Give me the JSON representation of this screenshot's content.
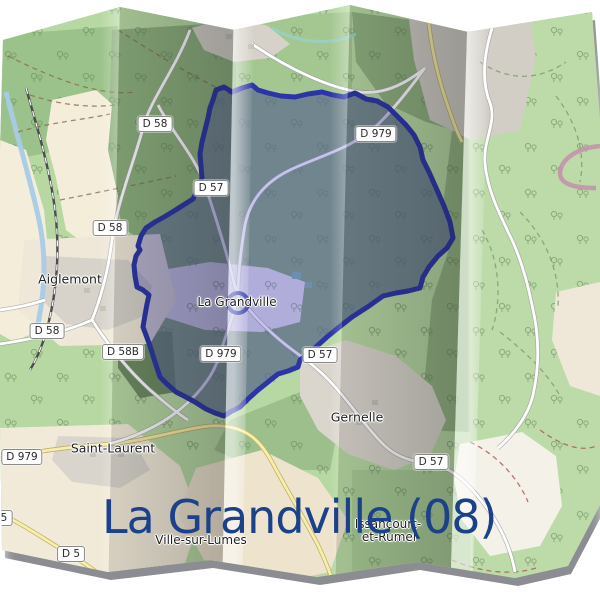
{
  "title": {
    "text": "La Grandville (08)",
    "color": "#1a4189"
  },
  "colors": {
    "boundary": "#2b35a8",
    "boundary_fill": "rgba(70,72,190,0.32)",
    "forest_green": "#8caf7c",
    "base_green": "#b7d8a2",
    "clearing_beige": "#f2ead8",
    "road_yellow": "#f6efab",
    "river_blue": "#a8cbe8"
  },
  "places": {
    "aiglemont": "Aiglemont",
    "la_grandville": "La Grandville",
    "gernelle": "Gernelle",
    "saint_laurent": "Saint-Laurent",
    "ville_sur_lumes": "Ville-sur-Lumes",
    "issancourt_line1": "Issancourt-",
    "issancourt_line2": "et-Rumel"
  },
  "shields": {
    "s1": "D 58",
    "s2": "D 979",
    "s3": "D 57",
    "s4": "D 58",
    "s5": "D 58",
    "s6": "D 58B",
    "s7": "D 979",
    "s8": "D 57",
    "s9": "D 979",
    "s10": "D 57",
    "s11": "D 5",
    "s12": "5"
  },
  "marker": {
    "type": "commune-center-circle"
  }
}
